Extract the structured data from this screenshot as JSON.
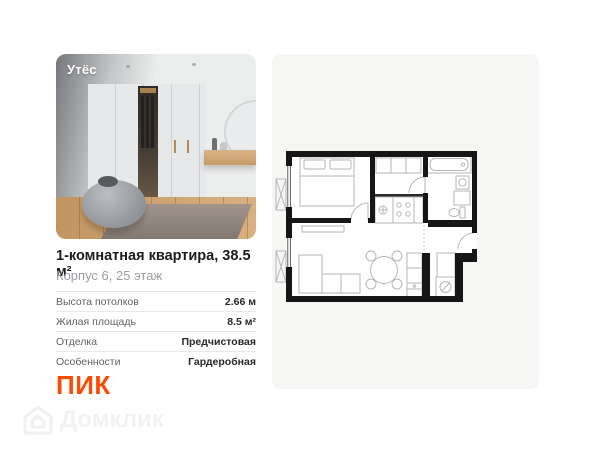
{
  "photo": {
    "badge": "Утёс"
  },
  "listing": {
    "title": "1-комнатная квартира, 38.5 м²",
    "subtitle": "Корпус 6, 25 этаж",
    "specs": [
      {
        "label": "Высота потолков",
        "value": "2.66 м"
      },
      {
        "label": "Жилая площадь",
        "value": "8.5 м²"
      },
      {
        "label": "Отделка",
        "value": "Предчистовая"
      },
      {
        "label": "Особенности",
        "value": "Гардеробная"
      }
    ]
  },
  "developer": {
    "logo_text": "ПИК"
  },
  "watermark": {
    "text": "Домклик"
  },
  "floor_plan": {
    "description": "1-room apartment plan: bedroom, bathroom, kitchen-living room, wardrobe"
  },
  "colors": {
    "brand_orange": "#FC4C02",
    "panel_background": "#f6f6f4",
    "title_text": "#1c1c1e",
    "subtitle_text": "#9a9da1",
    "wall_line": "#161616",
    "furniture_line": "#b4b6b8"
  }
}
